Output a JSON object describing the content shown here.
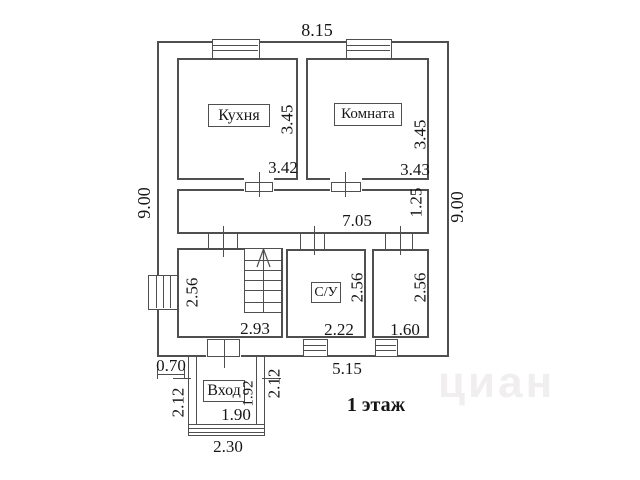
{
  "floor": {
    "title": "1 этаж"
  },
  "overall": {
    "top_width": "8.15",
    "left_height": "9.00",
    "right_height": "9.00",
    "bottom_width": "5.15"
  },
  "rooms": {
    "kitchen": {
      "label": "Кухня",
      "width": "3.42",
      "height": "3.45"
    },
    "living": {
      "label": "Комната",
      "width": "3.43",
      "height": "3.45"
    },
    "hallway": {
      "width": "7.05",
      "height": "1.25"
    },
    "stair_room": {
      "width": "2.93",
      "height": "2.56"
    },
    "wc": {
      "label": "С/У",
      "width": "2.22",
      "height": "2.56"
    },
    "storage": {
      "width": "1.60",
      "height": "2.56"
    }
  },
  "porch": {
    "label": "Вход",
    "offset": "0.70",
    "left_height": "2.12",
    "right_height": "2.12",
    "inner_height": "1.92",
    "inner_width": "1.90",
    "outer_width": "2.30"
  },
  "watermark": {
    "text": "циан"
  },
  "colors": {
    "line": "#4f4f4f",
    "text": "#161616"
  }
}
